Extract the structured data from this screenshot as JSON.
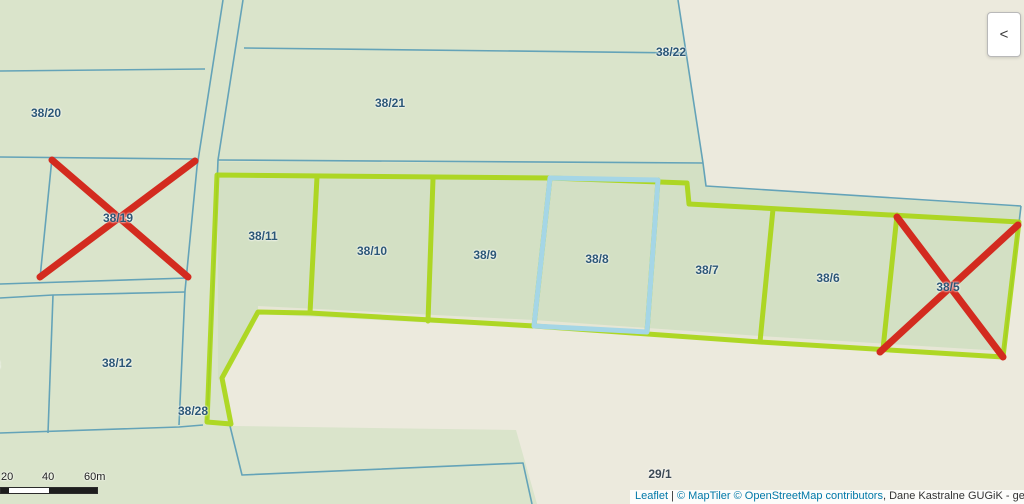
{
  "map": {
    "parcel_labels": [
      {
        "id": "38/20",
        "x": 46,
        "y": 113
      },
      {
        "id": "38/19",
        "x": 118,
        "y": 218,
        "crossed_out": true
      },
      {
        "id": "38/21",
        "x": 390,
        "y": 103
      },
      {
        "id": "38/22",
        "x": 671,
        "y": 52
      },
      {
        "id": "38/11",
        "x": 263,
        "y": 236,
        "highlighted": true
      },
      {
        "id": "38/10",
        "x": 372,
        "y": 251,
        "highlighted": true
      },
      {
        "id": "38/9",
        "x": 485,
        "y": 255,
        "highlighted": true
      },
      {
        "id": "38/8",
        "x": 597,
        "y": 259,
        "highlighted": true,
        "selected": true
      },
      {
        "id": "38/7",
        "x": 707,
        "y": 270,
        "highlighted": true
      },
      {
        "id": "38/6",
        "x": 828,
        "y": 278,
        "highlighted": true
      },
      {
        "id": "38/5",
        "x": 948,
        "y": 287,
        "crossed_out": true
      },
      {
        "id": "38/12",
        "x": 117,
        "y": 363
      },
      {
        "id": "38/28",
        "x": 193,
        "y": 411
      },
      {
        "id": "29/1",
        "x": 660,
        "y": 474,
        "color": "#3d4a55"
      },
      {
        "id": "8",
        "x": -3,
        "y": 365,
        "partial": true
      }
    ],
    "crossed_out_parcels": [
      "38/19",
      "38/5"
    ],
    "selected_parcel": "38/8",
    "highlighted_group": [
      "38/11",
      "38/10",
      "38/9",
      "38/8",
      "38/7",
      "38/6"
    ],
    "colors": {
      "base_green": "#dae4cb",
      "field_green": "#d3e0c4",
      "beige": "#eceadd",
      "boundary_teal": "#64a3b8",
      "highlight_lime": "#a9d613",
      "selection_cyan": "#a5d6e6",
      "cross_red": "#d32b1f",
      "label_blue": "#2c5777"
    }
  },
  "scale_bar": {
    "labels": [
      {
        "text": "20",
        "x": 1
      },
      {
        "text": "40",
        "x": 42
      },
      {
        "text": "60m",
        "x": 84
      }
    ]
  },
  "attribution": {
    "leaflet": "Leaflet",
    "separator": " | ",
    "maptiler": "© MapTiler ",
    "osm": "© OpenStreetMap contributors",
    "rest": ", Dane Kastralne GUGiK - geoportal.gov.pl (20"
  },
  "controls": {
    "collapse_chevron": "<"
  }
}
